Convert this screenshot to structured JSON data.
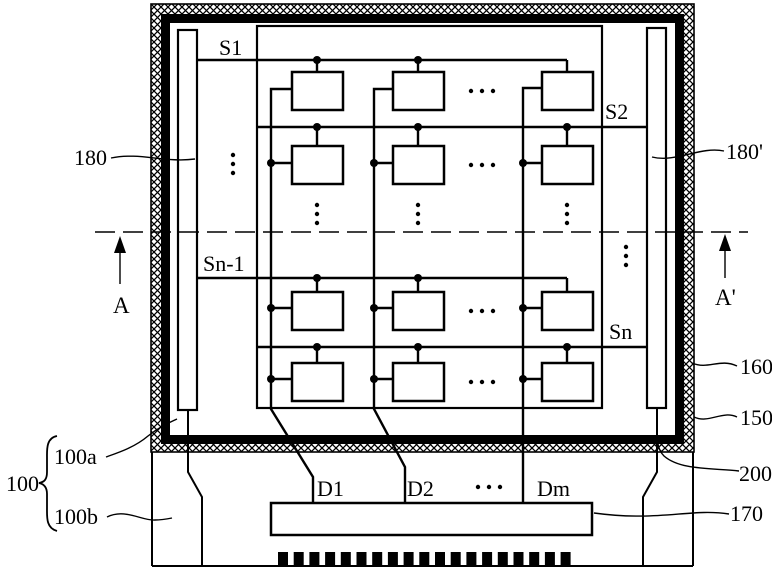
{
  "figure": {
    "scan_labels": {
      "s1": "S1",
      "s2": "S2",
      "sn_minus_1": "Sn-1",
      "sn": "Sn"
    },
    "data_labels": {
      "d1": "D1",
      "d2": "D2",
      "dm": "Dm"
    },
    "refs": {
      "ref_100": "100",
      "ref_100a": "100a",
      "ref_100b": "100b",
      "ref_180": "180",
      "ref_180_prime": "180'",
      "ref_160": "160",
      "ref_150": "150",
      "ref_200": "200",
      "ref_170": "170"
    },
    "section_markers": {
      "a": "A",
      "a_prime": "A'"
    },
    "colors": {
      "line": "#000000",
      "background": "#ffffff"
    }
  }
}
